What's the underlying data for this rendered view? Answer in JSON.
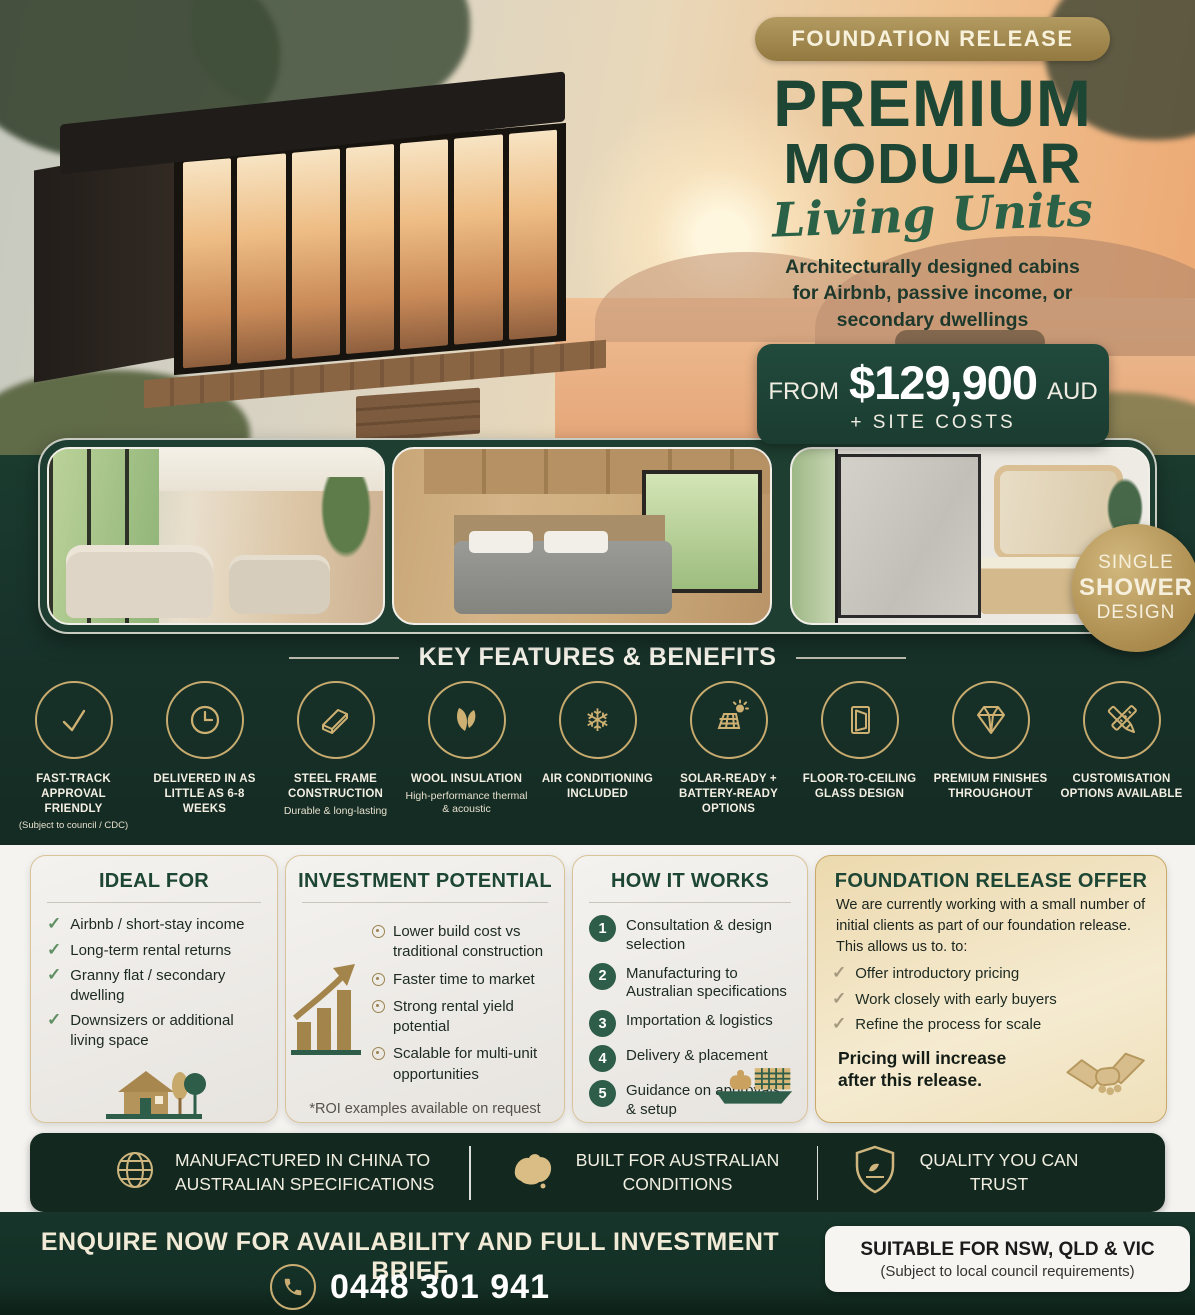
{
  "hero": {
    "badge": "FOUNDATION RELEASE",
    "title1": "PREMIUM",
    "title2": "MODULAR",
    "script": "Living Units",
    "subtitle": "Architecturally designed cabins for Airbnb, passive income, or secondary dwellings",
    "price_prefix": "FROM",
    "price_amount": "$129,900",
    "price_currency": "AUD",
    "price_note": "+ SITE COSTS"
  },
  "strip": {
    "photos": [
      "living-room",
      "bedroom",
      "bathroom"
    ],
    "badge_line1": "SINGLE",
    "badge_line2": "SHOWER",
    "badge_line3": "DESIGN"
  },
  "features": {
    "heading": "KEY FEATURES & BENEFITS",
    "items": [
      {
        "icon": "check-icon",
        "title": "FAST-TRACK APPROVAL FRIENDLY",
        "note": "(Subject to council / CDC)"
      },
      {
        "icon": "clock-icon",
        "title": "DELIVERED IN AS LITTLE AS 6-8 WEEKS",
        "note": ""
      },
      {
        "icon": "steel-beam-icon",
        "title": "STEEL FRAME CONSTRUCTION",
        "note": "Durable & long-lasting"
      },
      {
        "icon": "wool-leaves-icon",
        "title": "WOOL INSULATION",
        "note": "High-performance thermal & acoustic"
      },
      {
        "icon": "snowflake-icon",
        "title": "AIR CONDITIONING INCLUDED",
        "note": ""
      },
      {
        "icon": "solar-panel-icon",
        "title": "SOLAR-READY + BATTERY-READY OPTIONS",
        "note": ""
      },
      {
        "icon": "window-icon",
        "title": "FLOOR-TO-CEILING GLASS DESIGN",
        "note": ""
      },
      {
        "icon": "diamond-icon",
        "title": "PREMIUM FINISHES THROUGHOUT",
        "note": ""
      },
      {
        "icon": "pencil-ruler-icon",
        "title": "CUSTOMISATION OPTIONS AVAILABLE",
        "note": ""
      }
    ]
  },
  "ideal_for": {
    "heading": "IDEAL FOR",
    "items": [
      "Airbnb / short-stay income",
      "Long-term rental returns",
      "Granny flat / secondary dwelling",
      "Downsizers or additional living space"
    ]
  },
  "investment": {
    "heading": "INVESTMENT POTENTIAL",
    "items": [
      "Lower build cost vs traditional construction",
      "Faster time to market",
      "Strong rental yield potential",
      "Scalable for multi-unit opportunities"
    ],
    "footnote": "*ROI examples available on request"
  },
  "how_it_works": {
    "heading": "HOW IT WORKS",
    "steps": [
      {
        "num": "1",
        "text": "Consultation & design selection"
      },
      {
        "num": "2",
        "text": "Manufacturing to Australian specifications"
      },
      {
        "num": "3",
        "text": "Importation & logistics"
      },
      {
        "num": "4",
        "text": "Delivery & placement"
      },
      {
        "num": "5",
        "text": "Guidance on approvals & setup"
      }
    ]
  },
  "offer": {
    "heading": "FOUNDATION RELEASE OFFER",
    "intro": "We are currently working with a small number of initial clients as part of our foundation release. This allows us to. to:",
    "items": [
      "Offer introductory pricing",
      "Work closely with early buyers",
      "Refine the process for scale"
    ],
    "highlight": "Pricing will increase after this release."
  },
  "info_bar": {
    "items": [
      {
        "icon": "globe-icon",
        "text": "MANUFACTURED IN CHINA TO AUSTRALIAN SPECIFICATIONS"
      },
      {
        "icon": "australia-map-icon",
        "text": "BUILT FOR AUSTRALIAN CONDITIONS"
      },
      {
        "icon": "shield-icon",
        "text": "QUALITY YOU CAN TRUST"
      }
    ]
  },
  "footer": {
    "headline": "ENQUIRE NOW FOR AVAILABILITY AND FULL INVESTMENT BRIEF",
    "phone": "0448 301 941",
    "suitable_title": "SUITABLE FOR NSW, QLD & VIC",
    "suitable_note": "(Subject to local council requirements)"
  },
  "icons": {
    "check_glyph": "✓",
    "snowflake_glyph": "❄"
  },
  "colors": {
    "dark_green": "#17352a",
    "deep_green": "#13291f",
    "price_green": "#1d4236",
    "gold": "#c8ab6e",
    "cream": "#f3ecd9",
    "heading_green": "#1d4634",
    "offer_tan": "#ecd9ae"
  }
}
